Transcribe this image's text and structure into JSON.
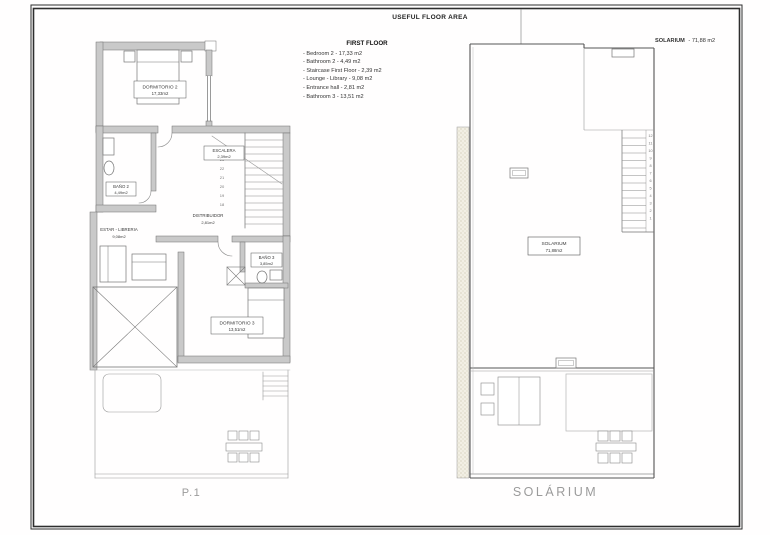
{
  "header": {
    "title": "USEFUL FLOOR AREA",
    "solarium_label": "SOLARIUM",
    "solarium_area": "- 71,88 m2"
  },
  "legend": {
    "title": "FIRST FLOOR",
    "items": [
      "- Bedroom 2 - 17,33 m2",
      "- Bathroom 2 - 4,49 m2",
      "- Staircase First Floor - 2,39 m2",
      "- Lounge - Library - 9,08 m2",
      "- Entrance hall - 2,81 m2",
      "- Bathroom 3 - 13,51 m2"
    ]
  },
  "plan_p1": {
    "caption": "P.1",
    "rooms": {
      "dormitorio2": {
        "name": "DORMITORIO 2",
        "area": "17,33m2"
      },
      "bano2": {
        "name": "BAÑO 2",
        "area": "4,49m2"
      },
      "escalera": {
        "name": "ESCALERA",
        "area": "2,39m2"
      },
      "distribuidor": {
        "name": "DISTRIBUIDOR",
        "area": "2,81m2"
      },
      "estar_libreria": {
        "name": "ESTAR - LIBRERIA",
        "area": "9,08m2"
      },
      "bano3": {
        "name": "BAÑO 3",
        "area": "3,85m2"
      },
      "dormitorio3": {
        "name": "DORMITORIO 3",
        "area": "13,51m2"
      }
    },
    "stair_numbers": [
      "23",
      "22",
      "21",
      "20",
      "19",
      "18"
    ]
  },
  "plan_solarium": {
    "caption": "SOLÁRIUM",
    "room": {
      "name": "SOLARIUM",
      "area": "71,88m2"
    },
    "stair_numbers": [
      "12",
      "11",
      "10",
      "9",
      "8",
      "7",
      "6",
      "5",
      "4",
      "3",
      "2",
      "1"
    ]
  },
  "colors": {
    "line": "#555555",
    "wall_fill": "#c9c9c9",
    "caption": "#9b9b9b"
  }
}
